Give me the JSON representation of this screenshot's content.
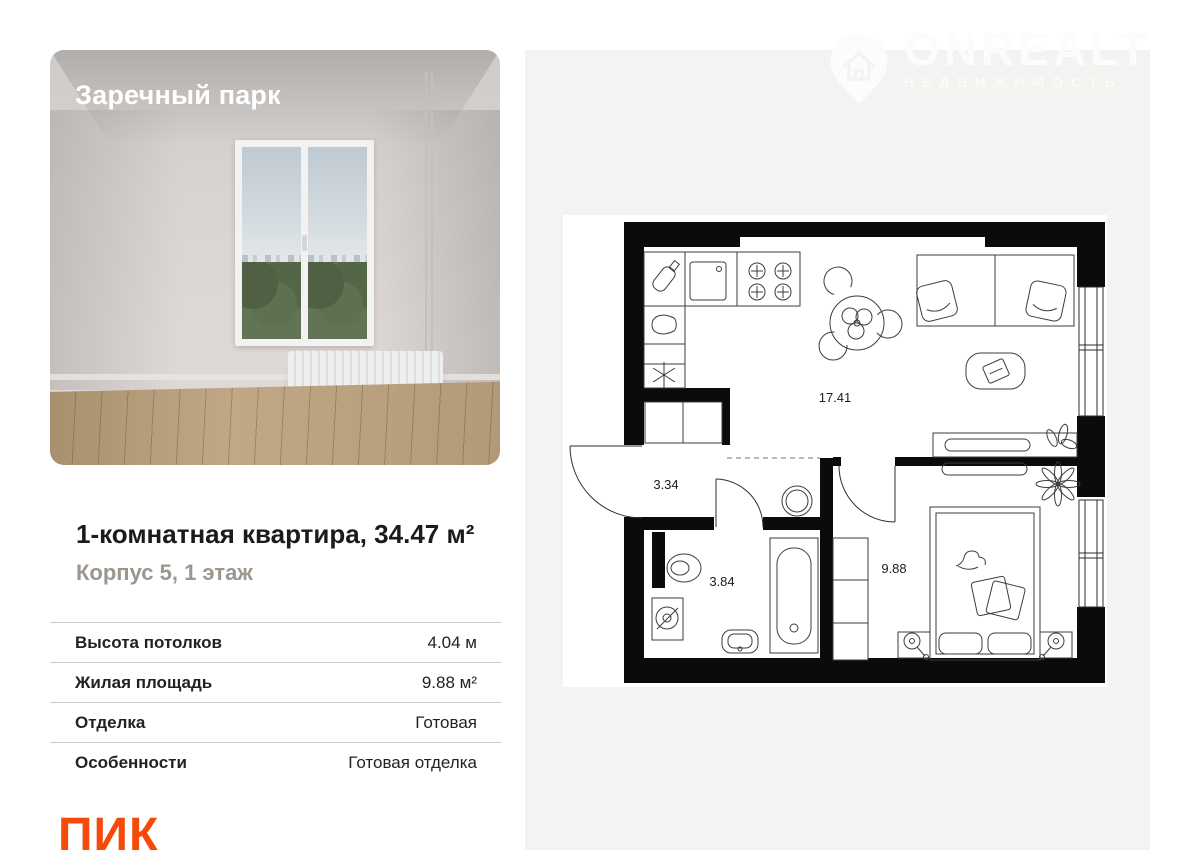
{
  "project": {
    "name": "Заречный парк"
  },
  "watermark": {
    "brand": "ONREALT",
    "tagline": "НЕДВИЖИМОСТЬ"
  },
  "listing": {
    "title": "1-комнатная квартира, 34.47 м²",
    "subtitle": "Корпус 5, 1 этаж"
  },
  "details": [
    {
      "label": "Высота потолков",
      "value": "4.04 м"
    },
    {
      "label": "Жилая площадь",
      "value": "9.88 м²"
    },
    {
      "label": "Отделка",
      "value": "Готовая"
    },
    {
      "label": "Особенности",
      "value": "Готовая отделка"
    }
  ],
  "developer": {
    "name": "ПИК"
  },
  "floorplan": {
    "areas": {
      "kitchen_living": "17.41",
      "hallway": "3.34",
      "bathroom": "3.84",
      "bedroom": "9.88"
    }
  },
  "colors": {
    "accent_orange": "#f54a0a",
    "panel_gray": "#f4f3f1",
    "wall_black": "#0b0b0b"
  }
}
